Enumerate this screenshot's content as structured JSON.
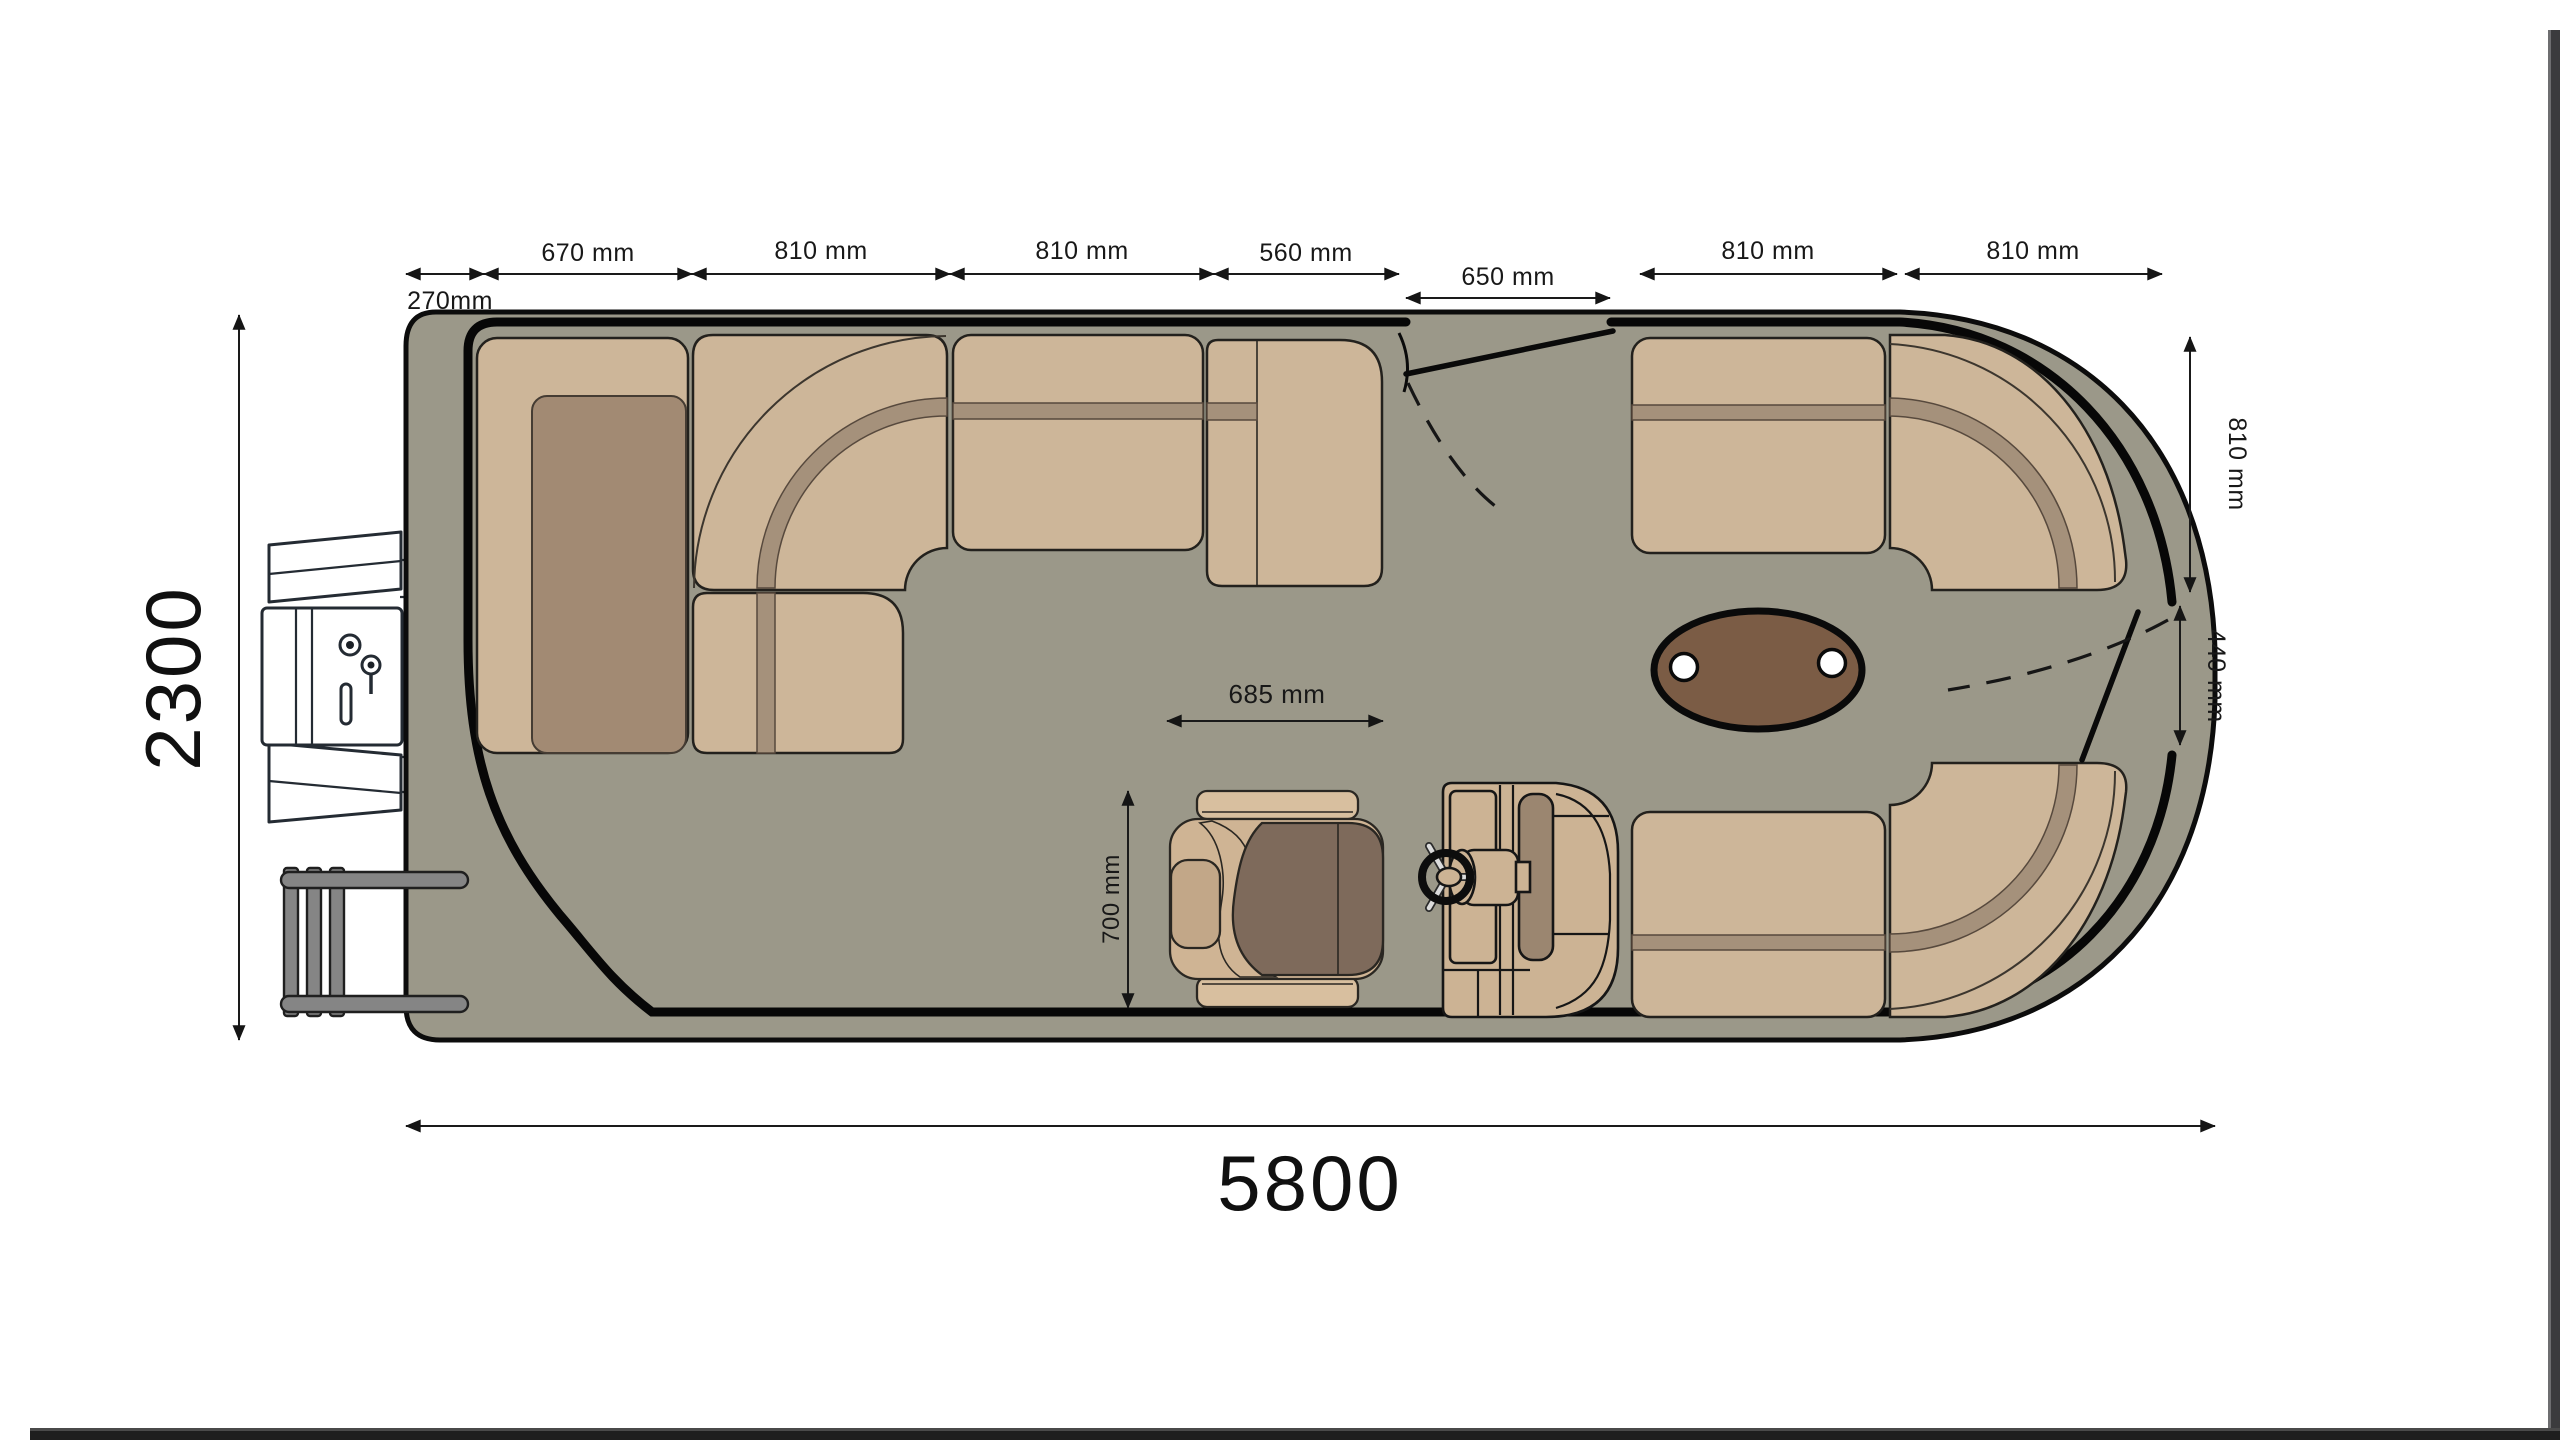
{
  "document": {
    "background": "#ffffff",
    "subject": "pontoon boat deck floor plan, top view"
  },
  "colors": {
    "deck": "#9b9889",
    "outline": "#0c0c0c",
    "seat": "#cdb699",
    "seat_stripe": "#a5917b",
    "seat_dark": "#a28a73",
    "table": "#7b5c45",
    "cup": "#ffffff",
    "console": "#ccb394",
    "console_inset": "#9b8670",
    "chair_light": "#d8bf9f",
    "chair_body": "#cfb494",
    "chair_wrap": "#b79b7c",
    "chair_seat": "#7e6a5b",
    "chair_pad": "#c2a788",
    "metal": "#858585",
    "motor": "#ffffff",
    "edge_right": "#3b3b3d",
    "edge_right_hl": "#6e6e70",
    "edge_bottom": "#1e1e1e",
    "edge_bottom_hl": "#4a4a4a"
  },
  "dimensions": {
    "overall_length": "5800",
    "overall_beam": "2300",
    "top_chain": [
      "270mm",
      "670 mm",
      "810 mm",
      "810 mm",
      "560 mm",
      "650 mm",
      "810 mm",
      "810 mm"
    ],
    "bow_side": [
      "810 mm",
      "440 mm"
    ],
    "helm_chair": {
      "width": "685 mm",
      "depth": "700 mm"
    }
  }
}
